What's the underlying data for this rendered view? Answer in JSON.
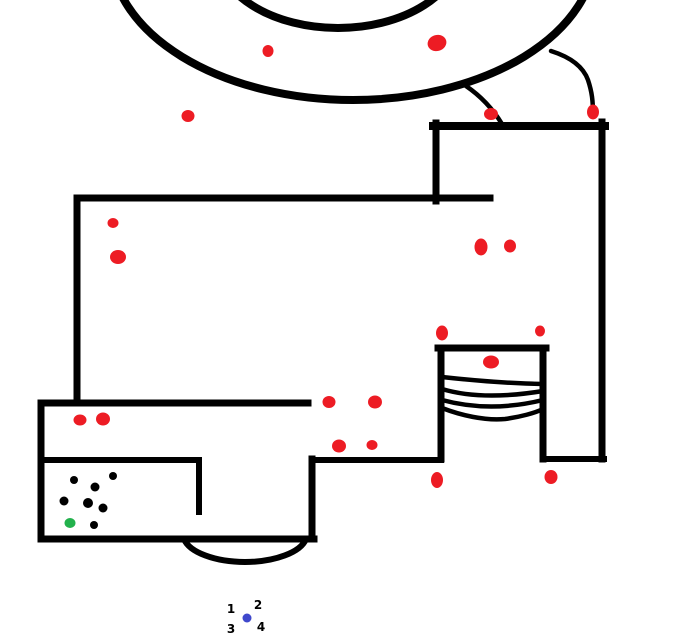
{
  "canvas": {
    "width": 684,
    "height": 636,
    "background": "#ffffff"
  },
  "palette": {
    "ink": "#000000",
    "red": "#ed1c24",
    "green": "#22b14c",
    "blue": "#3f48cc"
  },
  "drawing": {
    "rings": [
      {
        "name": "outer-ring",
        "cx": 353,
        "cy": -48,
        "rx": 242,
        "ry": 148,
        "w": 8
      },
      {
        "name": "inner-ring",
        "cx": 338,
        "cy": -50,
        "rx": 122,
        "ry": 78,
        "w": 8
      }
    ],
    "walls": [
      {
        "name": "tower-top",
        "x1": 433,
        "y1": 126,
        "x2": 605,
        "y2": 126,
        "w": 8
      },
      {
        "name": "tower-left",
        "x1": 436,
        "y1": 123,
        "x2": 436,
        "y2": 201,
        "w": 7
      },
      {
        "name": "right-wall",
        "x1": 602,
        "y1": 122,
        "x2": 602,
        "y2": 459,
        "w": 7
      },
      {
        "name": "main-top-wall",
        "x1": 77,
        "y1": 198,
        "x2": 490,
        "y2": 198,
        "w": 7
      },
      {
        "name": "left-wall",
        "x1": 77,
        "y1": 198,
        "x2": 77,
        "y2": 403,
        "w": 7
      },
      {
        "name": "box-top",
        "x1": 41,
        "y1": 403,
        "x2": 308,
        "y2": 403,
        "w": 7
      },
      {
        "name": "box-left",
        "x1": 41,
        "y1": 403,
        "x2": 41,
        "y2": 539,
        "w": 7
      },
      {
        "name": "box-bottom",
        "x1": 41,
        "y1": 539,
        "x2": 314,
        "y2": 539,
        "w": 7
      },
      {
        "name": "step-right",
        "x1": 312,
        "y1": 459,
        "x2": 312,
        "y2": 539,
        "w": 7
      },
      {
        "name": "step-top",
        "x1": 312,
        "y1": 460,
        "x2": 441,
        "y2": 460,
        "w": 6
      },
      {
        "name": "shelf",
        "x1": 41,
        "y1": 460,
        "x2": 199,
        "y2": 460,
        "w": 6
      },
      {
        "name": "shelf-drop",
        "x1": 199,
        "y1": 460,
        "x2": 199,
        "y2": 512,
        "w": 6
      },
      {
        "name": "coil-top",
        "x1": 438,
        "y1": 348,
        "x2": 546,
        "y2": 348,
        "w": 7
      },
      {
        "name": "coil-left",
        "x1": 441,
        "y1": 348,
        "x2": 441,
        "y2": 459,
        "w": 7
      },
      {
        "name": "coil-right",
        "x1": 543,
        "y1": 348,
        "x2": 543,
        "y2": 459,
        "w": 7
      },
      {
        "name": "bottom-right-wall",
        "x1": 543,
        "y1": 459,
        "x2": 604,
        "y2": 459,
        "w": 6
      }
    ],
    "curves": [
      {
        "name": "rope-left",
        "d": "M 466 86 Q 488 101 502 124",
        "w": 4.5
      },
      {
        "name": "rope-right",
        "d": "M 551 51 C 570 57 583 66 588 80 C 592 92 593 101 593 115",
        "w": 4.5
      },
      {
        "name": "dome-arc",
        "d": "M 184 539 A 62 28 0 0 0 306 539",
        "w": 6
      },
      {
        "name": "coil-line",
        "d": "M 442 377 Q 495 383 543 384",
        "w": 4.5
      },
      {
        "name": "coil-line",
        "d": "M 442 389 Q 482 401 543 391",
        "w": 4.5
      },
      {
        "name": "coil-line",
        "d": "M 442 400 Q 490 413 543 400",
        "w": 4.5
      },
      {
        "name": "coil-line",
        "d": "M 442 408 C 460 415 485 421 505 419 C 520 417 535 413 543 409",
        "w": 4.5
      }
    ],
    "red_dots": [
      {
        "cx": 268,
        "cy": 51,
        "rx": 5.5,
        "ry": 6
      },
      {
        "cx": 437,
        "cy": 43,
        "rx": 9.5,
        "ry": 8,
        "rot": -15
      },
      {
        "cx": 188,
        "cy": 116,
        "rx": 6.5,
        "ry": 6
      },
      {
        "cx": 491,
        "cy": 114,
        "rx": 7,
        "ry": 6
      },
      {
        "cx": 593,
        "cy": 112,
        "rx": 6,
        "ry": 7.5
      },
      {
        "cx": 113,
        "cy": 223,
        "rx": 5.5,
        "ry": 5
      },
      {
        "cx": 118,
        "cy": 257,
        "rx": 8,
        "ry": 7
      },
      {
        "cx": 481,
        "cy": 247,
        "rx": 6.5,
        "ry": 8.5
      },
      {
        "cx": 510,
        "cy": 246,
        "rx": 6,
        "ry": 6.5
      },
      {
        "cx": 442,
        "cy": 333,
        "rx": 6,
        "ry": 7.5
      },
      {
        "cx": 540,
        "cy": 331,
        "rx": 5,
        "ry": 5.5
      },
      {
        "cx": 491,
        "cy": 362,
        "rx": 8,
        "ry": 6.5
      },
      {
        "cx": 329,
        "cy": 402,
        "rx": 6.5,
        "ry": 6
      },
      {
        "cx": 375,
        "cy": 402,
        "rx": 7,
        "ry": 6.5
      },
      {
        "cx": 339,
        "cy": 446,
        "rx": 7,
        "ry": 6.5
      },
      {
        "cx": 372,
        "cy": 445,
        "rx": 5.5,
        "ry": 5
      },
      {
        "cx": 80,
        "cy": 420,
        "rx": 6.5,
        "ry": 5.5
      },
      {
        "cx": 103,
        "cy": 419,
        "rx": 7,
        "ry": 6.5
      },
      {
        "cx": 437,
        "cy": 480,
        "rx": 6,
        "ry": 8
      },
      {
        "cx": 551,
        "cy": 477,
        "rx": 6.5,
        "ry": 7
      }
    ],
    "black_dots": [
      {
        "cx": 74,
        "cy": 480,
        "r": 4
      },
      {
        "cx": 113,
        "cy": 476,
        "r": 4
      },
      {
        "cx": 95,
        "cy": 487,
        "r": 4.5
      },
      {
        "cx": 64,
        "cy": 501,
        "r": 4.5
      },
      {
        "cx": 88,
        "cy": 503,
        "r": 5
      },
      {
        "cx": 103,
        "cy": 508,
        "r": 4.5
      },
      {
        "cx": 94,
        "cy": 525,
        "r": 4
      }
    ],
    "green_dot": {
      "cx": 70,
      "cy": 523,
      "rx": 5.5,
      "ry": 5
    },
    "blue_dot": {
      "cx": 247,
      "cy": 618,
      "rx": 4.5,
      "ry": 4.5
    },
    "labels": [
      {
        "text": "1",
        "x": 231,
        "y": 609
      },
      {
        "text": "2",
        "x": 258,
        "y": 605
      },
      {
        "text": "3",
        "x": 231,
        "y": 629
      },
      {
        "text": "4",
        "x": 261,
        "y": 627
      }
    ]
  }
}
